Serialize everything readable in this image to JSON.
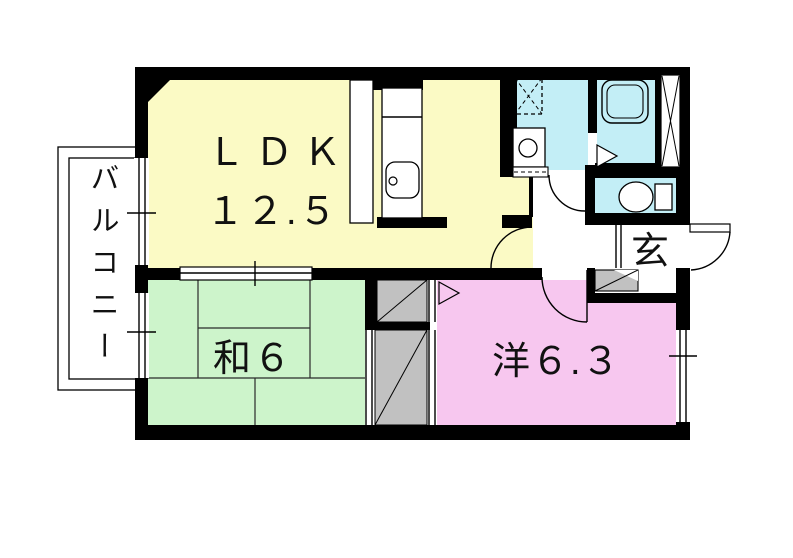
{
  "plan": {
    "title": "apartment floor plan",
    "rooms": {
      "ldk": {
        "label": "ＬＤＫ",
        "area": "１２.５"
      },
      "japanese_room": {
        "label": "和６"
      },
      "western_room": {
        "label": "洋６.３"
      },
      "entrance": {
        "label": "玄"
      },
      "balcony": {
        "label": "バルコニー"
      }
    },
    "colors": {
      "ldk": "#fbfac5",
      "japanese_room": "#cdf4cb",
      "western_room": "#f7c7ef",
      "wet_area": "#c3eef6",
      "closet": "#c1c1c1",
      "wall": "#000000",
      "floor": "#ffffff"
    },
    "fixtures": [
      "bathtub",
      "toilet",
      "wash-basin",
      "washing-machine-pan",
      "kitchen-counter",
      "kitchen-sink",
      "refrigerator-space",
      "entrance-step",
      "pipe-space"
    ]
  }
}
